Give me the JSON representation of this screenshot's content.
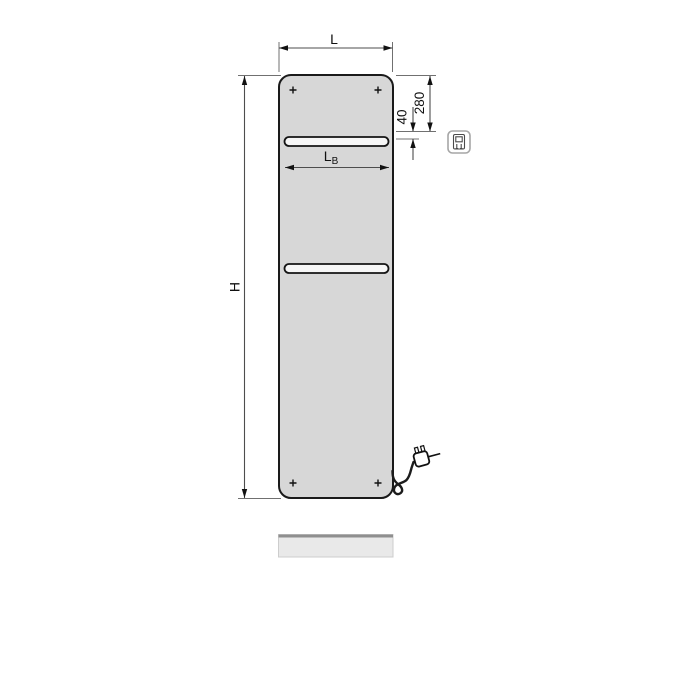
{
  "drawing": {
    "name": "panel-radiator-dimension-diagram",
    "labels": {
      "width": "L",
      "height": "H",
      "bar_width_main": "L",
      "bar_width_sub": "B",
      "top_offset": "280",
      "bar_offset": "40"
    },
    "icons": {
      "control_unit": "electric-control-unit-icon",
      "plug": "power-plug-icon",
      "screw": "mounting-screw-cross-icon"
    },
    "colors": {
      "background": "#ffffff",
      "panel_fill": "#d7d7d7",
      "panel_stroke": "#1a1a1a",
      "rail_fill": "#f6f6f6",
      "dimension_line": "#4d4d4d",
      "extension_line": "#707070",
      "label_text": "#111111",
      "plate_fill": "#e9e9e9",
      "plate_top_edge": "#8f8f8f",
      "icon_border": "#a6a6a6"
    }
  }
}
